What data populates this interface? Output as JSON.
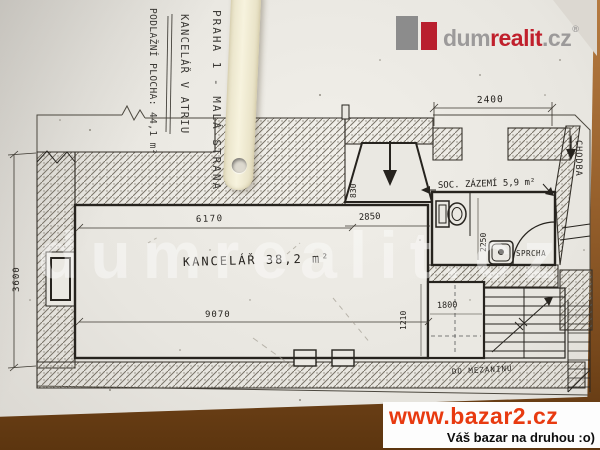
{
  "colors": {
    "paper": "#eae8e2",
    "wood_light": "#b57a40",
    "wood_dark": "#5c350f",
    "ink": "#26231e",
    "logo_gray": "#9c9a9a",
    "logo_red": "#c0202c",
    "bazar_red": "#e83a10",
    "strip_cream": "#f2edd7",
    "watermark_white": "rgba(255,255,255,0.42)"
  },
  "handwriting": {
    "location": "PRAHA 1 - MALÁ STRANA",
    "title": "KANCELÁŘ V ATRIU",
    "area": "PODLAŽNÍ PLOCHA: 44,1 m²"
  },
  "logo": {
    "part1": "dum",
    "part2": "realit",
    "part3": ".cz",
    "registered": "®"
  },
  "watermark_text": "dumrealit.cz",
  "plan": {
    "office_label": "KANCELÁŘ 38,2 m²",
    "sanitary_label": "SOC. ZÁZEMÍ 5,9 m²",
    "shower_label": "SPRCHA",
    "corridor_label": "CHODBA",
    "stairs_label": "DO MEZANINU",
    "dims": {
      "bay_width": "2400",
      "office_top": "6170",
      "office_bottom": "9070",
      "office_height": "3600",
      "entry_depth": "830",
      "entry_width": "2850",
      "sanitary_depth": "2250",
      "landing_height": "1210",
      "landing_width": "1800"
    }
  },
  "bazar": {
    "url": "www.bazar2.cz",
    "tagline": "Váš bazar na druhou :o)"
  }
}
